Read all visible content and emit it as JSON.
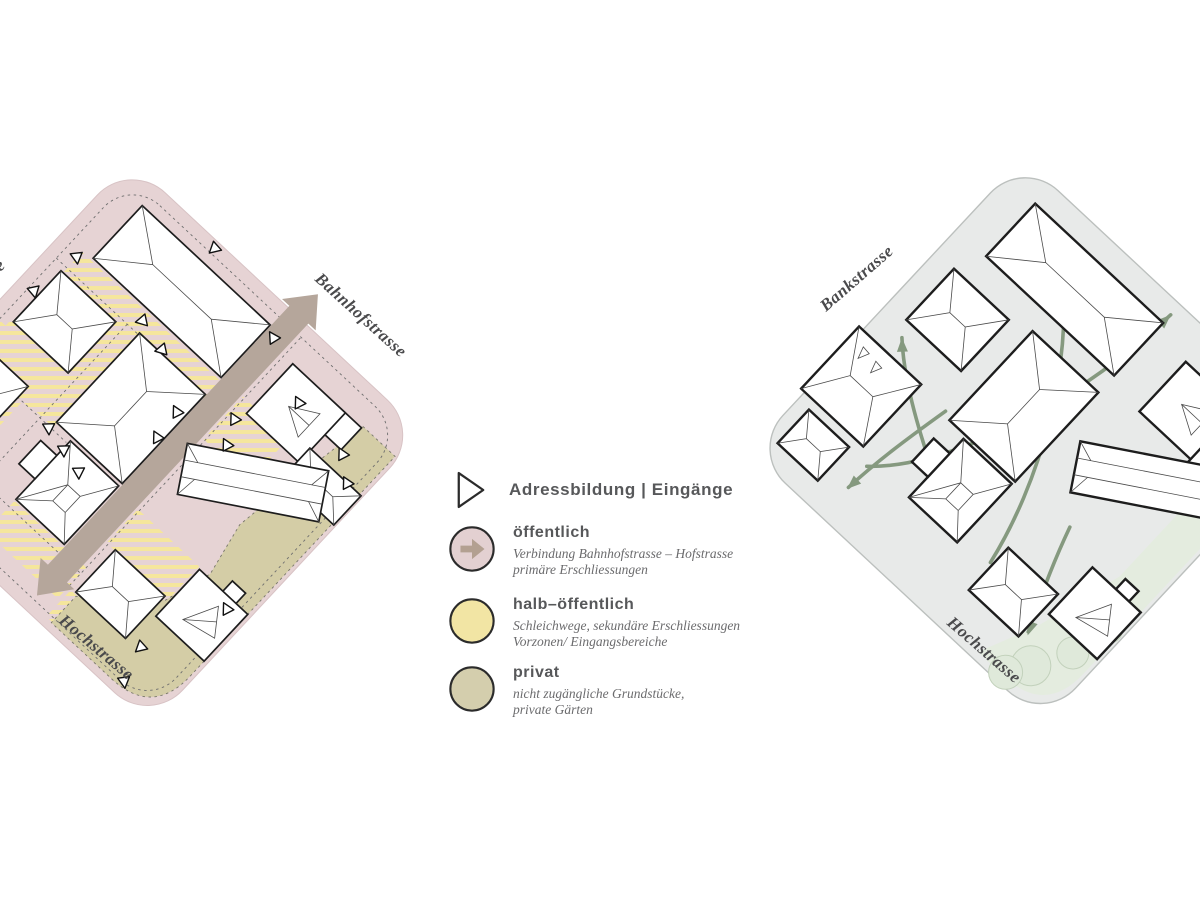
{
  "legend": {
    "address_label": "Adressbildung | Eingänge",
    "zones": [
      {
        "name": "öffentlich",
        "desc1": "Verbindung Bahnhofstrasse – Hofstrasse",
        "desc2": "primäre Erschliessungen",
        "color": "#e3d0d1"
      },
      {
        "name": "halb–öffentlich",
        "desc1": "Schleichwege, sekundäre Erschliessungen",
        "desc2": "Vorzonen/ Eingangsbereiche",
        "color": "#f2e5a4"
      },
      {
        "name": "privat",
        "desc1": "nicht zugängliche Grundstücke,",
        "desc2": "private Gärten",
        "color": "#d4cead"
      }
    ]
  },
  "left_plan": {
    "streets": {
      "bahnhofstrasse": "Bahnhofstrasse",
      "hochstrasse": "Hochstrasse",
      "hofstrasse_partial": "e"
    },
    "colors": {
      "public": "#e6d3d4",
      "semi_public": "#f5e69c",
      "private": "#d4cda6",
      "connection_arrow": "#b5a69b"
    }
  },
  "right_plan": {
    "streets": {
      "bankstrasse": "Bankstrasse",
      "hochstrasse": "Hochstrasse"
    },
    "colors": {
      "ground": "#e8eae9",
      "circulation": "#85997f",
      "green_edge": "#e4ecdf"
    }
  }
}
